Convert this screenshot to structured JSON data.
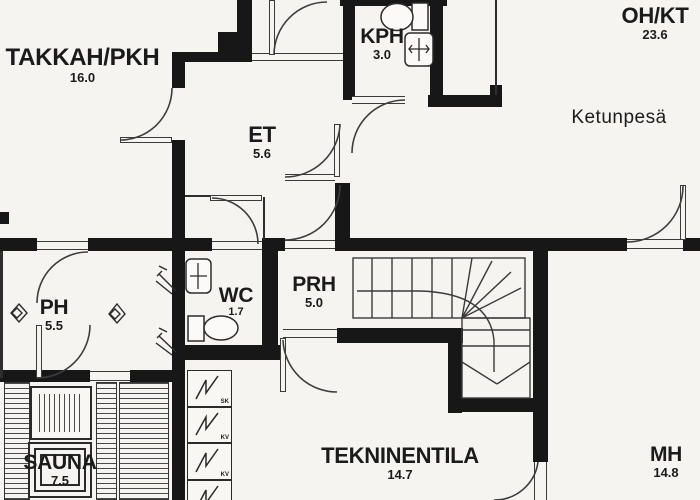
{
  "title": "floor-plan",
  "rooms": {
    "takkah": {
      "name": "TAKKAH/PKH",
      "area": "16.0"
    },
    "et": {
      "name": "ET",
      "area": "5.6"
    },
    "kph": {
      "name": "KPH",
      "area": "3.0"
    },
    "ohkt": {
      "name": "OH/KT",
      "area": "23.6"
    },
    "ketunpesa": {
      "name": "Ketunpesä"
    },
    "wc": {
      "name": "WC",
      "area": "1.7"
    },
    "prh": {
      "name": "PRH",
      "area": "5.0"
    },
    "ph": {
      "name": "PH",
      "area": "5.5"
    },
    "sauna": {
      "name": "SAUNA",
      "area": "7.5"
    },
    "tekninentila": {
      "name": "TEKNINENTILA",
      "area": "14.7"
    },
    "mh": {
      "name": "MH",
      "area": "14.8"
    }
  },
  "equipment": {
    "boxes": [
      {
        "label": "SK"
      },
      {
        "label": "KV"
      },
      {
        "label": "KV"
      },
      {
        "label": "KV"
      }
    ]
  },
  "colors": {
    "wall": "#171717",
    "paper": "#f5f4f1",
    "line": "#3a3a3a"
  }
}
